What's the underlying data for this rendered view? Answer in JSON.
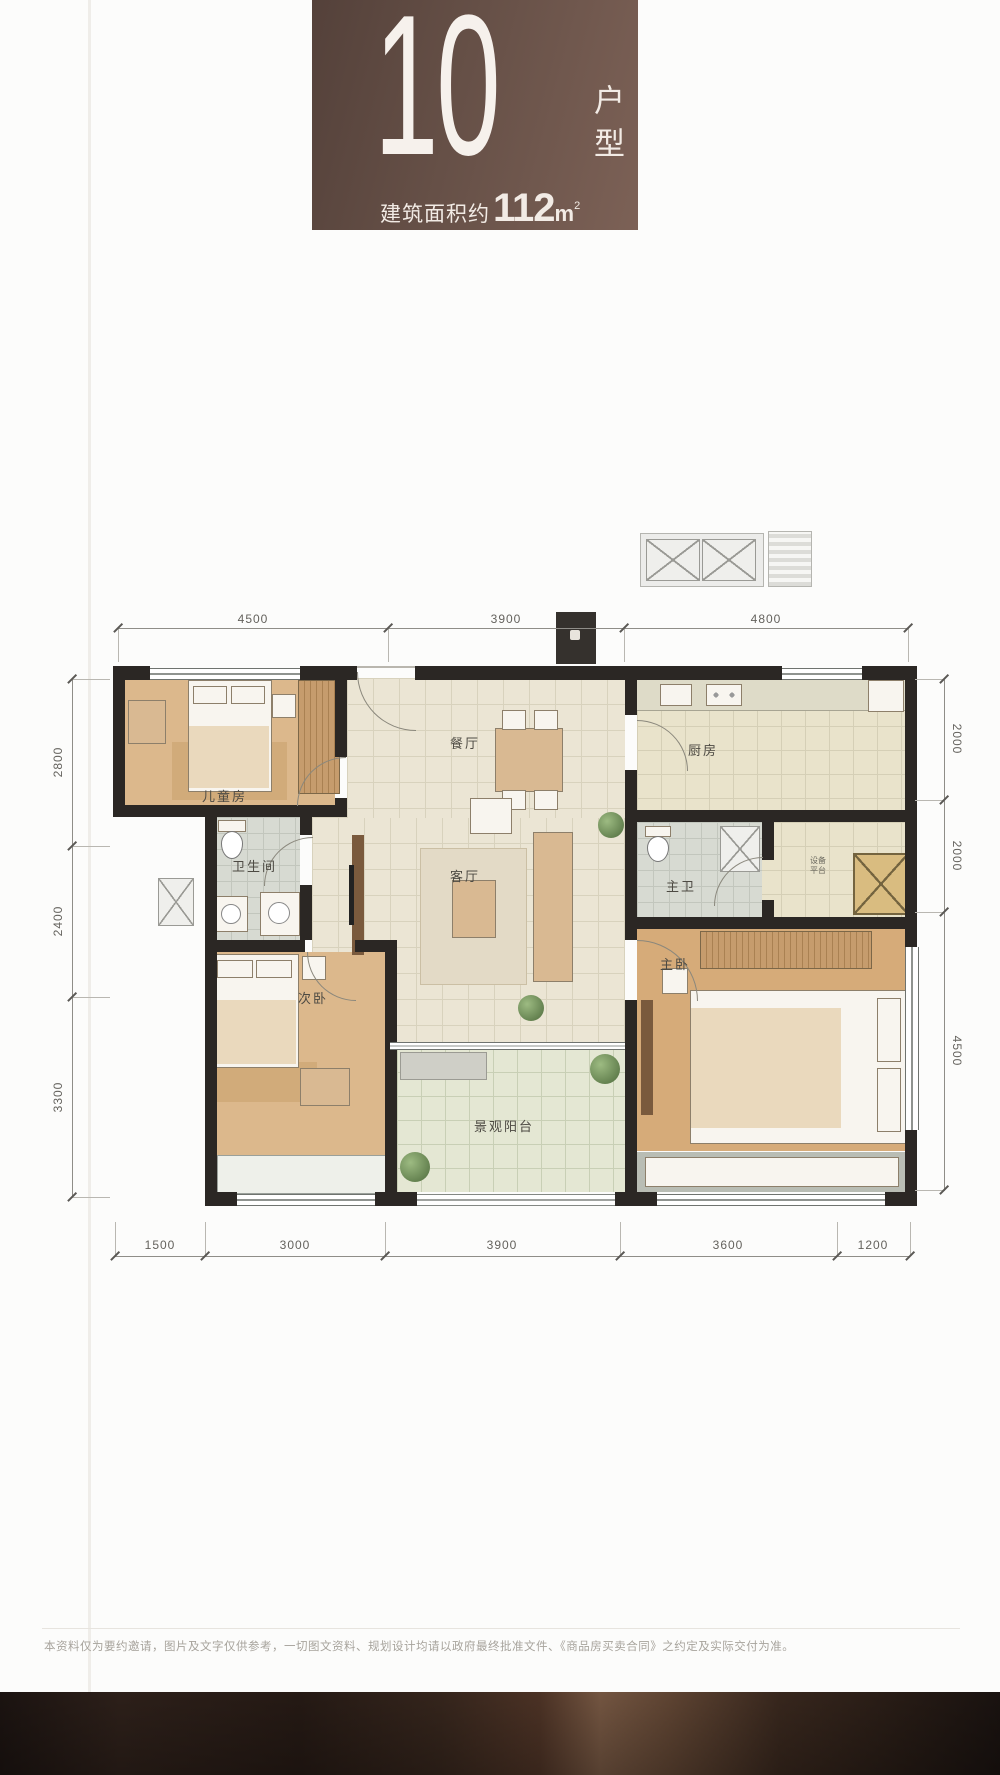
{
  "badge": {
    "number": "10",
    "type_label": "户型",
    "area_prefix": "建筑面积约",
    "area_value": "112",
    "area_unit_base": "m",
    "area_unit_sup": "2"
  },
  "rooms": {
    "children": "儿童房",
    "bathroom": "卫生间",
    "second_bedroom": "次卧",
    "dining": "餐厅",
    "living": "客厅",
    "balcony": "景观阳台",
    "kitchen": "厨房",
    "master_bathroom": "主卫",
    "master_bedroom": "主卧",
    "equipment": "设备平台"
  },
  "dimensions": {
    "top": [
      "4500",
      "3900",
      "4800"
    ],
    "bottom": [
      "1500",
      "3000",
      "3900",
      "3600",
      "1200"
    ],
    "left": [
      "2800",
      "2400",
      "3300"
    ],
    "right": [
      "2000",
      "2000",
      "4500"
    ]
  },
  "footer": {
    "disclaimer": "本资料仅为要约邀请，图片及文字仅供参考，一切图文资料、规划设计均请以政府最终批准文件、《商品房买卖合同》之约定及实际交付为准。"
  },
  "colors": {
    "badge_brown": "#665047",
    "wall_black": "#2b2724",
    "wood_floor": "#dcb88c",
    "tile_cream": "#ebe5d4",
    "bottom_bar": "#33241d"
  }
}
